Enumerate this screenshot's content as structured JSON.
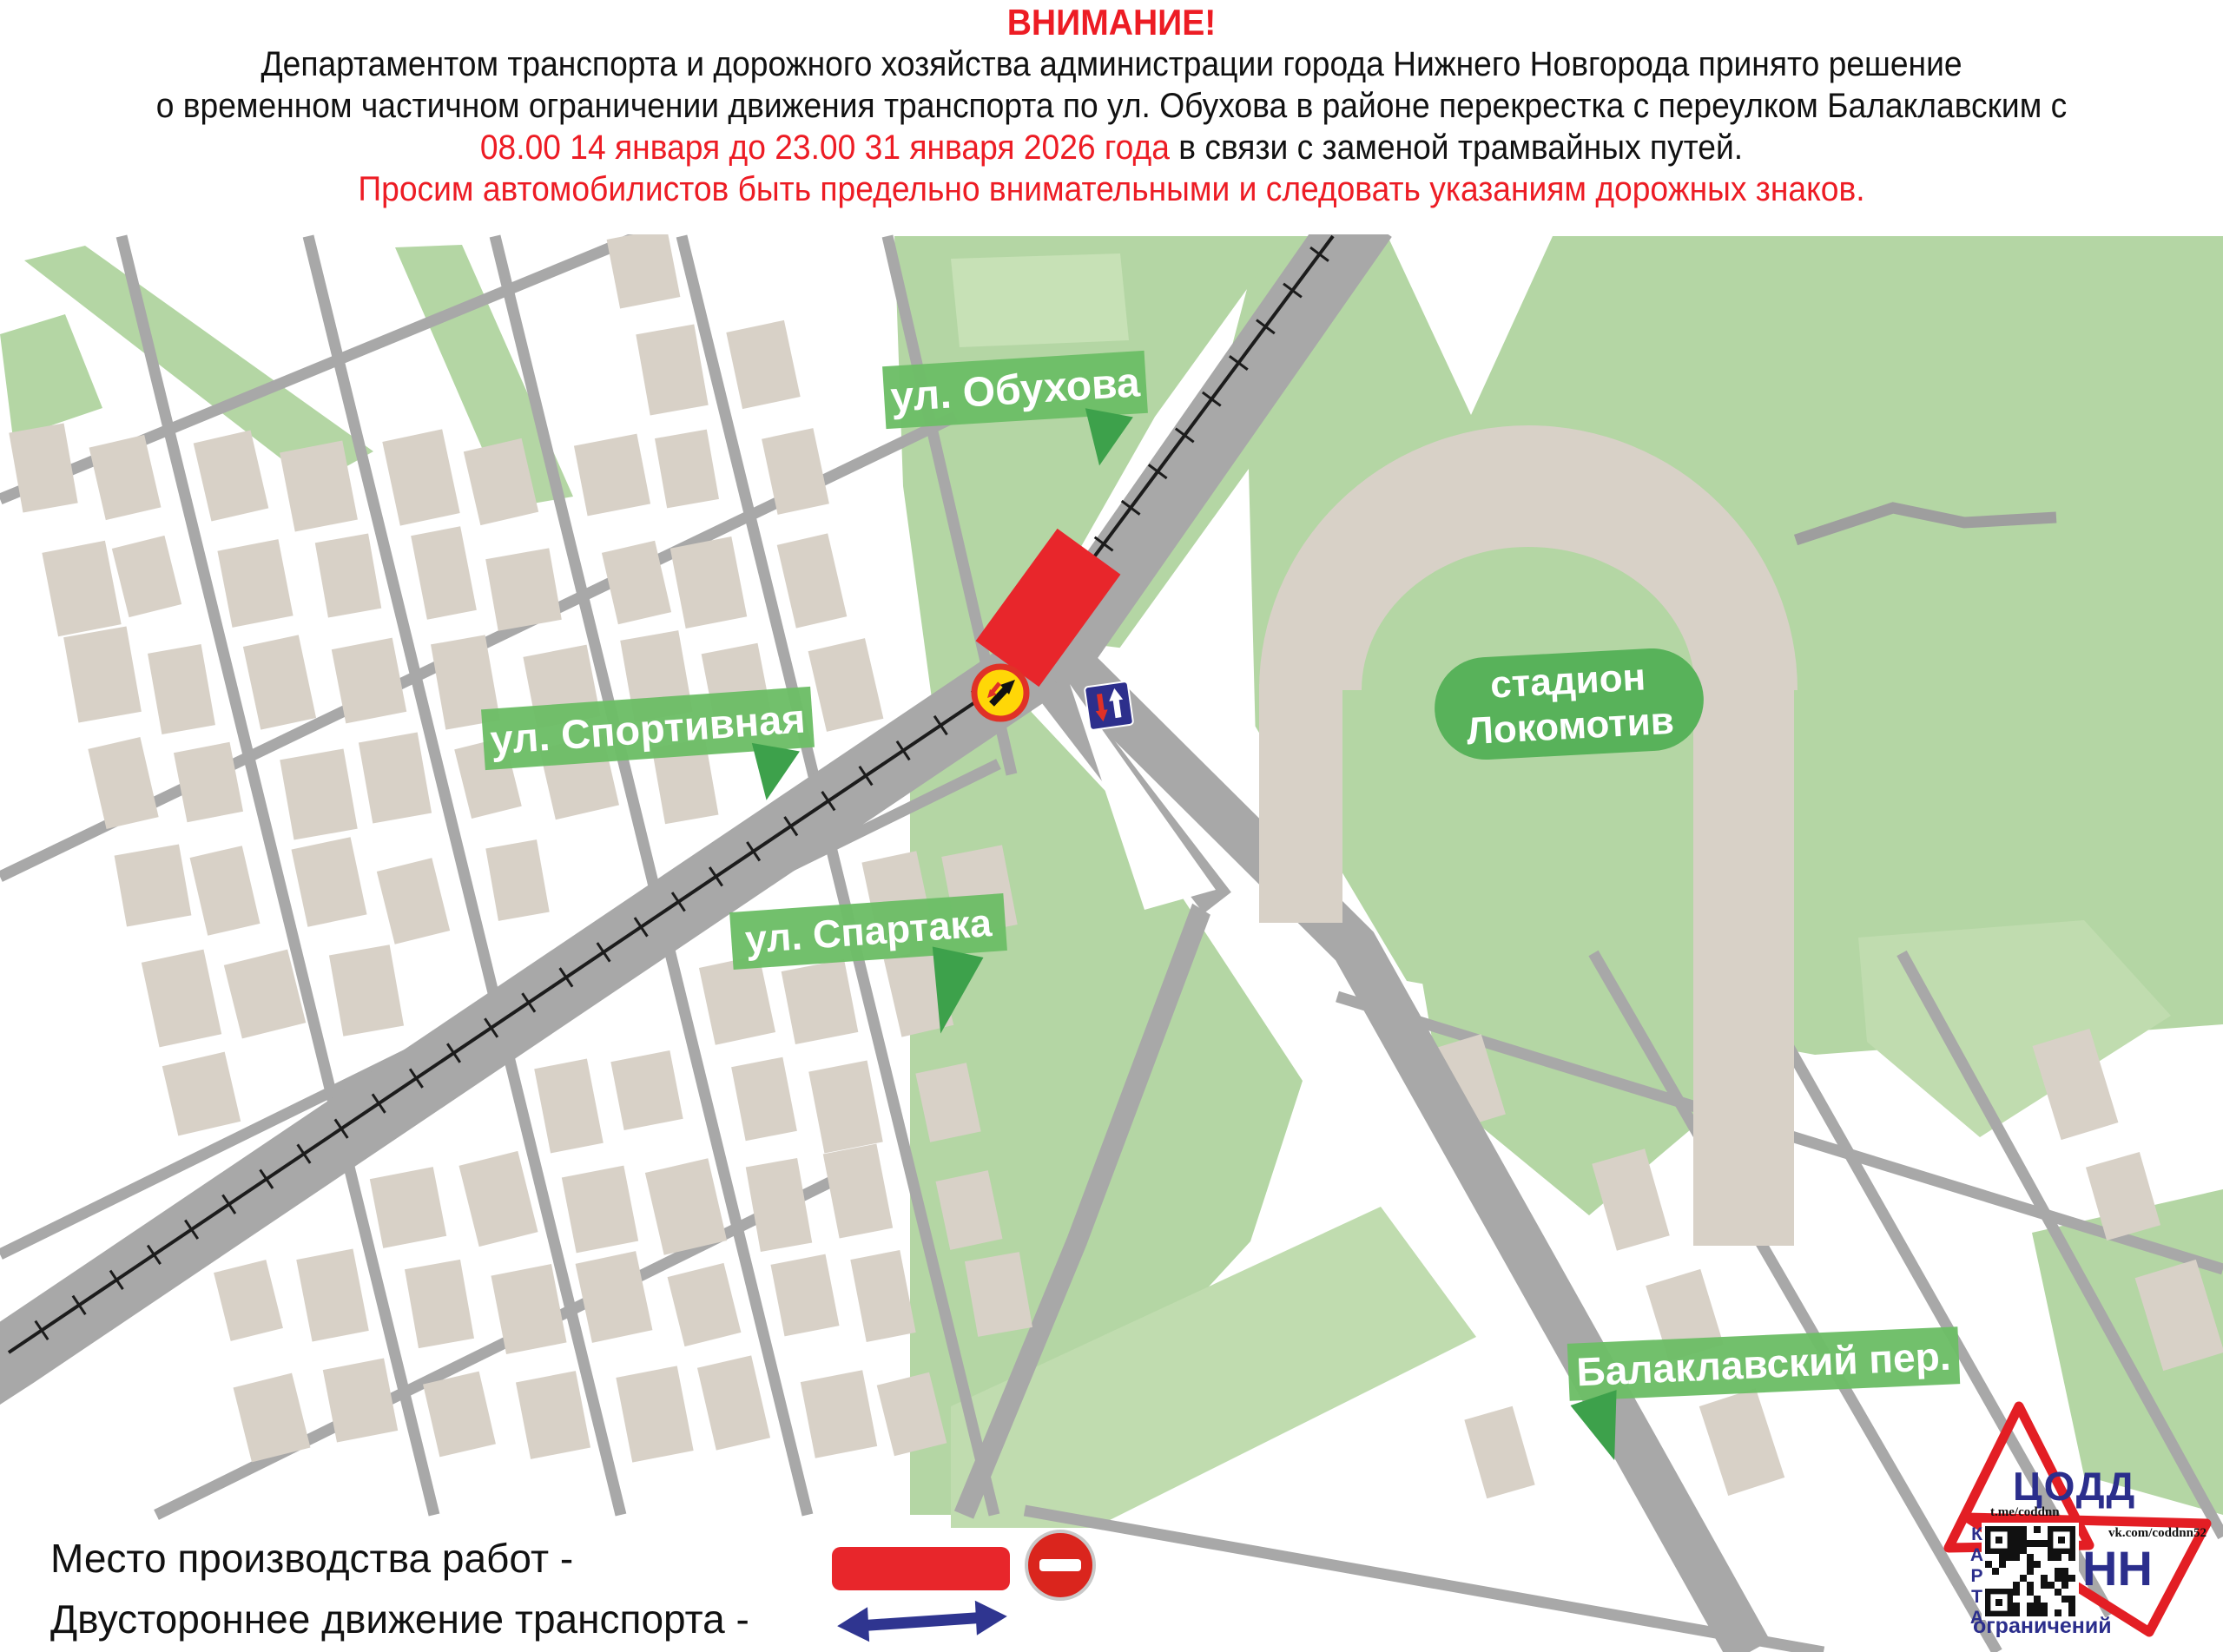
{
  "header": {
    "attention": "ВНИМАНИЕ!",
    "line1": "Департаментом транспорта и дорожного хозяйства администрации города Нижнего Новгорода принято решение",
    "line2": "о временном частичном ограничении движения транспорта по ул. Обухова в районе перекрестка с переулком Балаклавским  с",
    "line3_red": "08.00 14 января до 23.00 31 января 2026 года",
    "line3_black": " в связи с заменой трамвайных путей.",
    "line4": "Просим автомобилистов быть предельно внимательными и следовать указаниям дорожных знаков."
  },
  "map": {
    "labels": {
      "obukhova": "ул. Обухова",
      "sportivnaya": "ул. Спортивная",
      "spartaka": "ул. Спартака",
      "balaklavsky": "Балаклавский пер.",
      "stadium_line1": "стадион",
      "stadium_line2": "Локомотив"
    }
  },
  "legend": {
    "work_site": "Место производства работ -",
    "two_way": "Двустороннее движение транспорта -"
  },
  "logo": {
    "org": "ЦОДД",
    "city": "НН",
    "telegram": "t.me/coddnn",
    "vk": "vk.com/coddnn52",
    "map_word": "КАРТА",
    "restrictions_word": "ограничений"
  },
  "colors": {
    "alert_red": "#e8262b",
    "banner_green": "#6cbd66",
    "park_green": "#b4d6a4",
    "road_gray": "#a8a8a8",
    "building_beige": "#d8d1c7",
    "navy_blue": "#2f3590",
    "logo_red": "#e31e24"
  }
}
